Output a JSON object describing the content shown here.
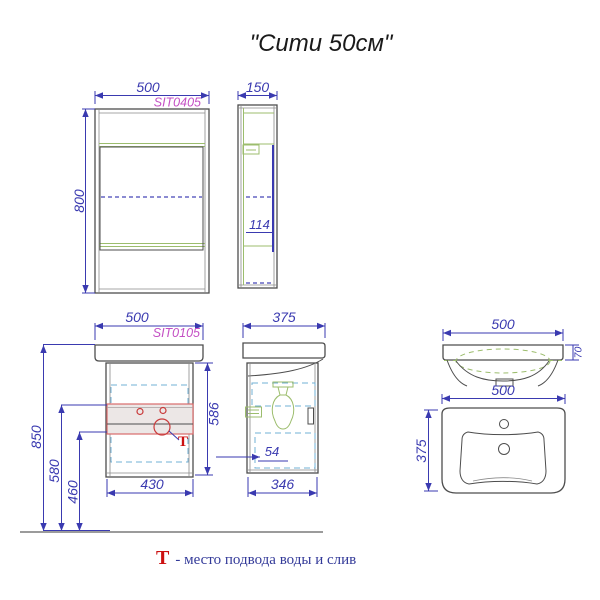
{
  "title": "\"Сити 50см\"",
  "colors": {
    "dimension_blue": "#3a3ab0",
    "model_magenta": "#c44fc4",
    "outline_gray": "#4d4d4d",
    "shelf_green": "#9cbd6d",
    "hidden_cyan": "#72b0d4",
    "highlight_red": "#cc1111",
    "supply_zone_fill": "#ece7e6"
  },
  "views": {
    "mirror_front": {
      "width": "500",
      "model": "SIT0405",
      "height": "800"
    },
    "mirror_side": {
      "width": "150",
      "inner_depth": "114"
    },
    "vanity_front": {
      "width": "500",
      "model": "SIT0105",
      "total_height": "850",
      "supply_height": "580",
      "drain_height": "460",
      "cabinet_height": "586",
      "cabinet_width": "430",
      "supply_mark": "Т"
    },
    "vanity_side": {
      "depth": "375",
      "bottom_depth": "346",
      "offset": "54"
    },
    "sink_front": {
      "width": "500",
      "rim_height": "70"
    },
    "sink_top": {
      "width": "500",
      "depth": "375"
    }
  },
  "legend": {
    "symbol": "Т",
    "text": "- место подвода воды и слив"
  }
}
